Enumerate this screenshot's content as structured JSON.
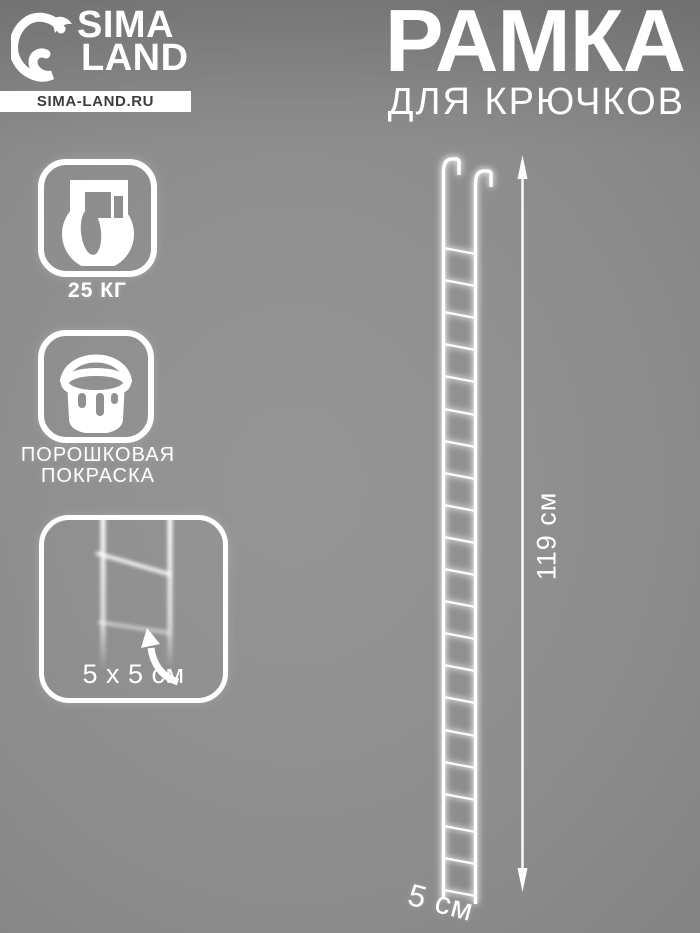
{
  "brand": {
    "name_line1": "SIMA",
    "name_line2": "LAND",
    "website": "SIMA-LAND.RU",
    "logo_icon": "sima-land-dolphin-icon"
  },
  "title": {
    "main": "РАМКА",
    "sub": "ДЛЯ КРЮЧКОВ"
  },
  "features": [
    {
      "icon": "kettlebell-weight-icon",
      "label": "25 КГ"
    },
    {
      "icon": "paint-bucket-icon",
      "label_line1": "ПОРОШКОВАЯ",
      "label_line2": "ПОКРАСКА"
    }
  ],
  "detail": {
    "icon": "grid-cell-zoom-detail",
    "label": "5 x 5 см"
  },
  "dimensions": {
    "height": "119 см",
    "width": "5 см"
  },
  "colors": {
    "background_center": "#959595",
    "background_edge": "#636363",
    "foreground": "#ffffff",
    "site_bar_background": "#ffffff",
    "site_bar_text": "#3c3c3c"
  }
}
